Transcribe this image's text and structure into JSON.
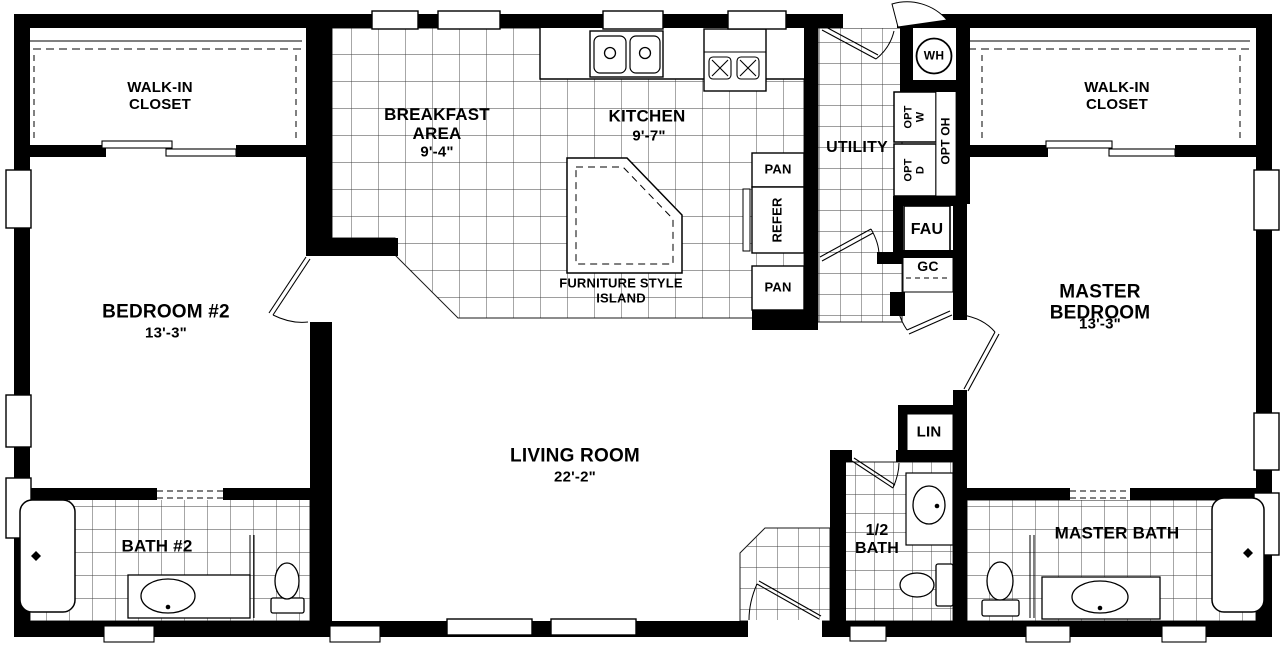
{
  "rooms": {
    "walk_in_closet_left": {
      "name": "WALK-IN\nCLOSET"
    },
    "bedroom_2": {
      "name": "BEDROOM #2",
      "dim": "13'-3\""
    },
    "bath_2": {
      "name": "BATH #2"
    },
    "breakfast_area": {
      "name": "BREAKFAST\nAREA",
      "dim": "9'-4\""
    },
    "kitchen": {
      "name": "KITCHEN",
      "dim": "9'-7\""
    },
    "living_room": {
      "name": "LIVING ROOM",
      "dim": "22'-2\""
    },
    "utility": {
      "name": "UTILITY"
    },
    "half_bath": {
      "name": "1/2\nBATH"
    },
    "walk_in_closet_right": {
      "name": "WALK-IN\nCLOSET"
    },
    "master_bedroom": {
      "name": "MASTER BEDROOM",
      "dim": "13'-3\""
    },
    "master_bath": {
      "name": "MASTER BATH"
    }
  },
  "labels": {
    "island": "FURNITURE STYLE\nISLAND",
    "pantry_upper": "PAN",
    "refrigerator": "REFER",
    "pantry_lower": "PAN",
    "water_heater": "WH",
    "opt_washer": "OPT\nW",
    "opt_dryer": "OPT\nD",
    "opt_overhead": "OPT OH",
    "fau": "FAU",
    "gc": "GC",
    "linen": "LIN"
  }
}
